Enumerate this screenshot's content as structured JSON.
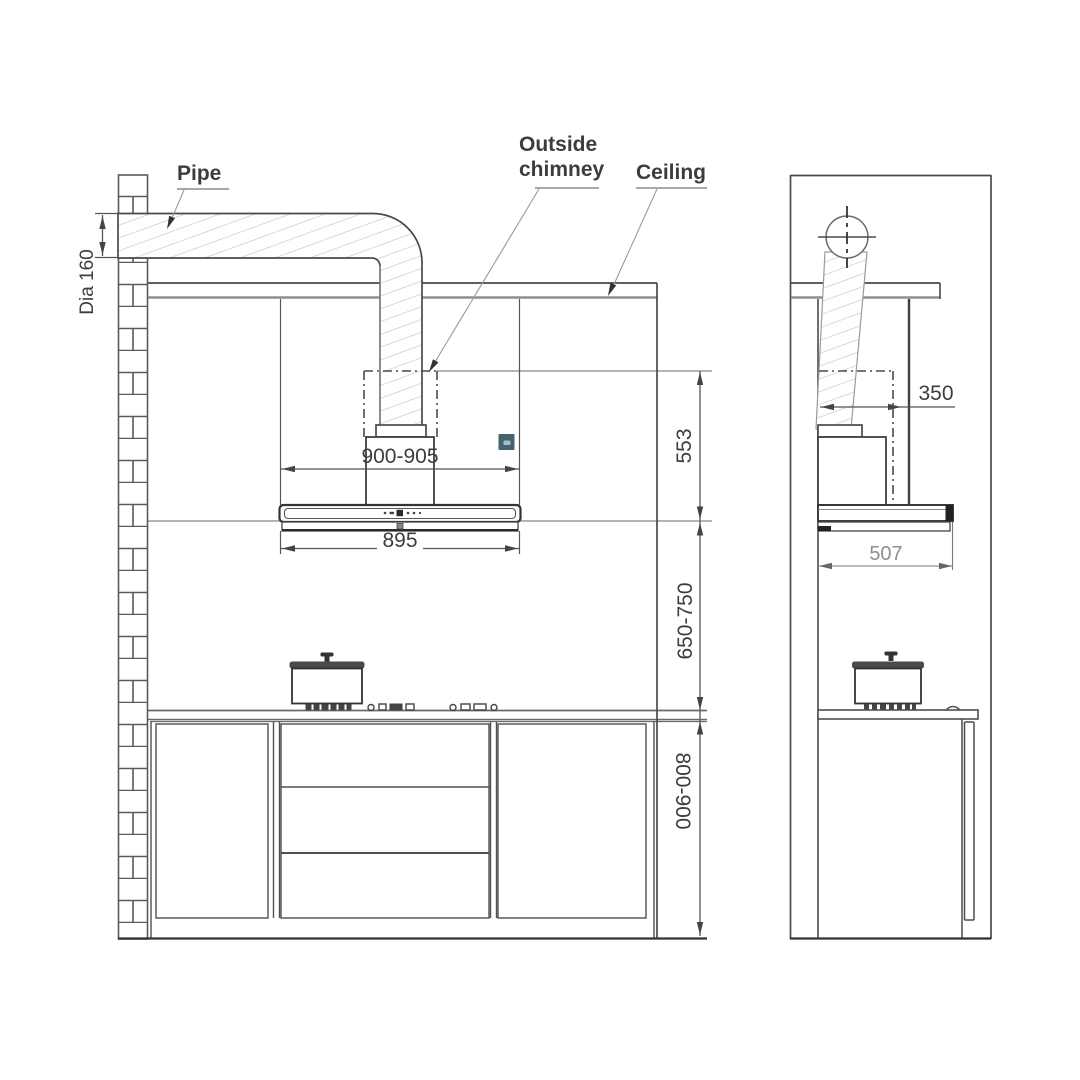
{
  "drawing": {
    "labels": {
      "pipe": "Pipe",
      "outside_chimney": "Outside\nchimney",
      "ceiling": "Ceiling",
      "pipe_diameter": "Dia 160"
    },
    "front_view": {
      "hood_width_range_mm": "900-905",
      "hood_body_width_mm": "895",
      "chimney_zone_height_mm": "553",
      "hood_to_counter_mm": "650-750",
      "counter_height_mm": "800-900"
    },
    "side_view": {
      "chimney_depth_mm": "350",
      "hood_depth_mm": "507"
    },
    "colors": {
      "line_dark": "#3f3f3f",
      "line_gray": "#909090",
      "hatch": "#c6c6c6",
      "badge_outer": "#47626f",
      "badge_inner": "#a7bac3"
    }
  }
}
